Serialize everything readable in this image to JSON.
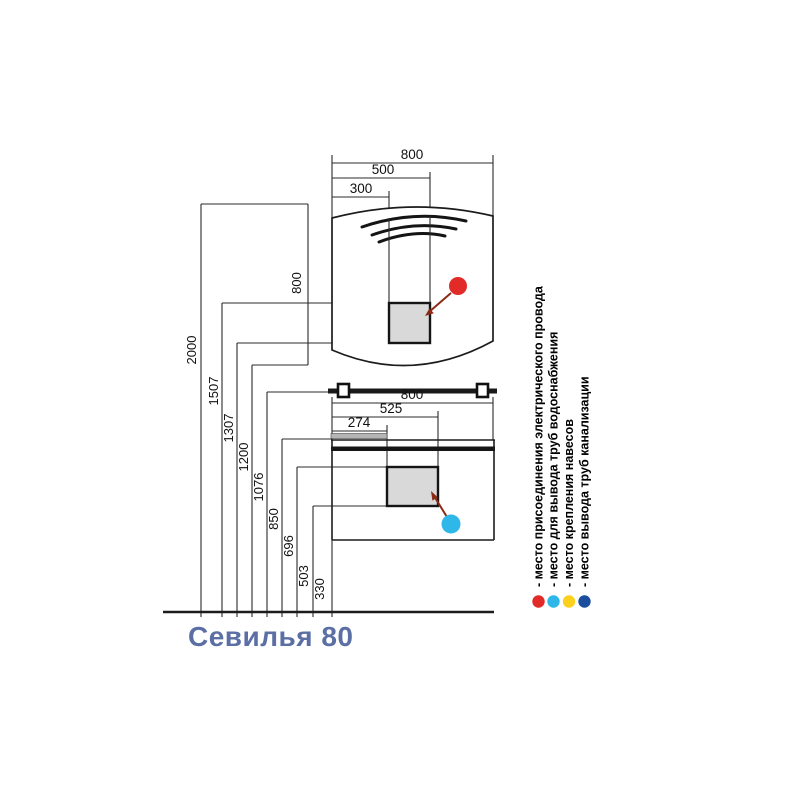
{
  "product": {
    "title": "Севилья 80",
    "title_color": "#5b6fa5"
  },
  "mirror": {
    "width_dim": "800",
    "mid_dim": "500",
    "inner_dim": "300",
    "height_dim": "800"
  },
  "vanity": {
    "width_dim": "800",
    "mid_dim": "525",
    "inner_dim": "274"
  },
  "heights": [
    "2000",
    "1507",
    "1307",
    "1200",
    "1076",
    "850",
    "696",
    "503",
    "330"
  ],
  "legend": {
    "items": [
      {
        "name": "electrical-connection",
        "label": "- место присоединения электрического провода",
        "color": "#e22a28"
      },
      {
        "name": "water-supply-pipes",
        "label": "- место для вывода труб водоснабжения",
        "color": "#2fb7e9"
      },
      {
        "name": "hanger-mounting",
        "label": "- место крепления навесов",
        "color": "#fdd01e"
      },
      {
        "name": "sewage-pipes",
        "label": "- место вывода труб канализации",
        "color": "#1b4f9e"
      }
    ]
  },
  "markers": {
    "electrical_color": "#e22a28",
    "water_color": "#2fb7e9"
  }
}
